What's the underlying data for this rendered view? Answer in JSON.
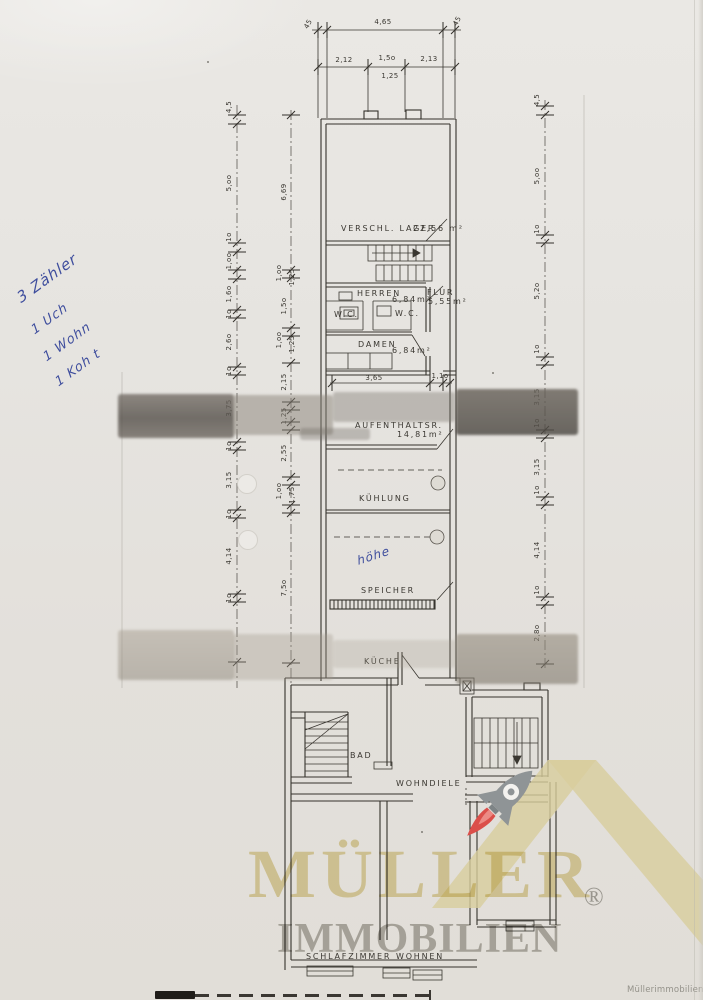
{
  "plan": {
    "rooms": {
      "verschl_lager": {
        "label": "VERSCHL. LAGER",
        "area": "22,56 m²"
      },
      "herren": {
        "label": "HERREN",
        "area": "6,84m²"
      },
      "flur": {
        "label": "FLUR",
        "area": "5,55m²"
      },
      "wc_left": {
        "label": "W.C."
      },
      "wc_right": {
        "label": "W.C."
      },
      "damen": {
        "label": "DAMEN",
        "area": "6,84m²"
      },
      "aufenthaltsraum": {
        "label": "AUFENTHALTSR.",
        "area": "14,81m²"
      },
      "kuehlung": {
        "label": "KÜHLUNG"
      },
      "speicher": {
        "label": "SPEICHER"
      },
      "kueche": {
        "label": "KÜCHE"
      },
      "bad": {
        "label": "BAD"
      },
      "wohndiele": {
        "label": "WOHNDIELE"
      },
      "schlafzimmer": {
        "label": "SCHLAFZIMMER"
      },
      "wohnen": {
        "label": "WOHNEN"
      }
    },
    "dims": {
      "top_width": "4,65",
      "top_left_45": "45",
      "top_right_45": "45",
      "row2": [
        "2,12",
        "1,5o",
        "1,25",
        "2,13"
      ],
      "mid": [
        "3,65",
        "1,1o"
      ],
      "left_outer": [
        "4,5",
        "5,oo",
        "1o",
        "1,oo",
        "1,6o",
        "1o",
        "2,6o",
        "1o",
        "3,75",
        "1o",
        "3,15",
        "1o",
        "4,14",
        "1o"
      ],
      "left_inner": [
        "6,69",
        "1,oo",
        "1,25",
        "1,5o",
        "1,oo",
        "1,25",
        "2,15",
        "1,25",
        "2,55",
        "1,oo",
        "1,75",
        "7,5o"
      ],
      "right_outer": [
        "4,5",
        "5,oo",
        "1o",
        "5,2o",
        "1o",
        "3,15",
        "1o",
        "3,15",
        "1o",
        "4,14",
        "1o",
        "2,8o"
      ]
    }
  },
  "handwriting": {
    "margin_lines": [
      "3 Zähler",
      "1 Uch",
      "1 Wohn",
      "1 Koh t"
    ],
    "plan_note": "höhe",
    "ink_color": "#2c3d96"
  },
  "logo": {
    "brand": "MÜLLER",
    "registered": "®",
    "subtitle": "IMMOBILIEN",
    "watermark": "Müllerimmobilien®",
    "gold": "#d8cd9c",
    "gray": "#a3a19c",
    "rocket_gray": "#8f9496",
    "flame_red": "#db4f4a"
  }
}
